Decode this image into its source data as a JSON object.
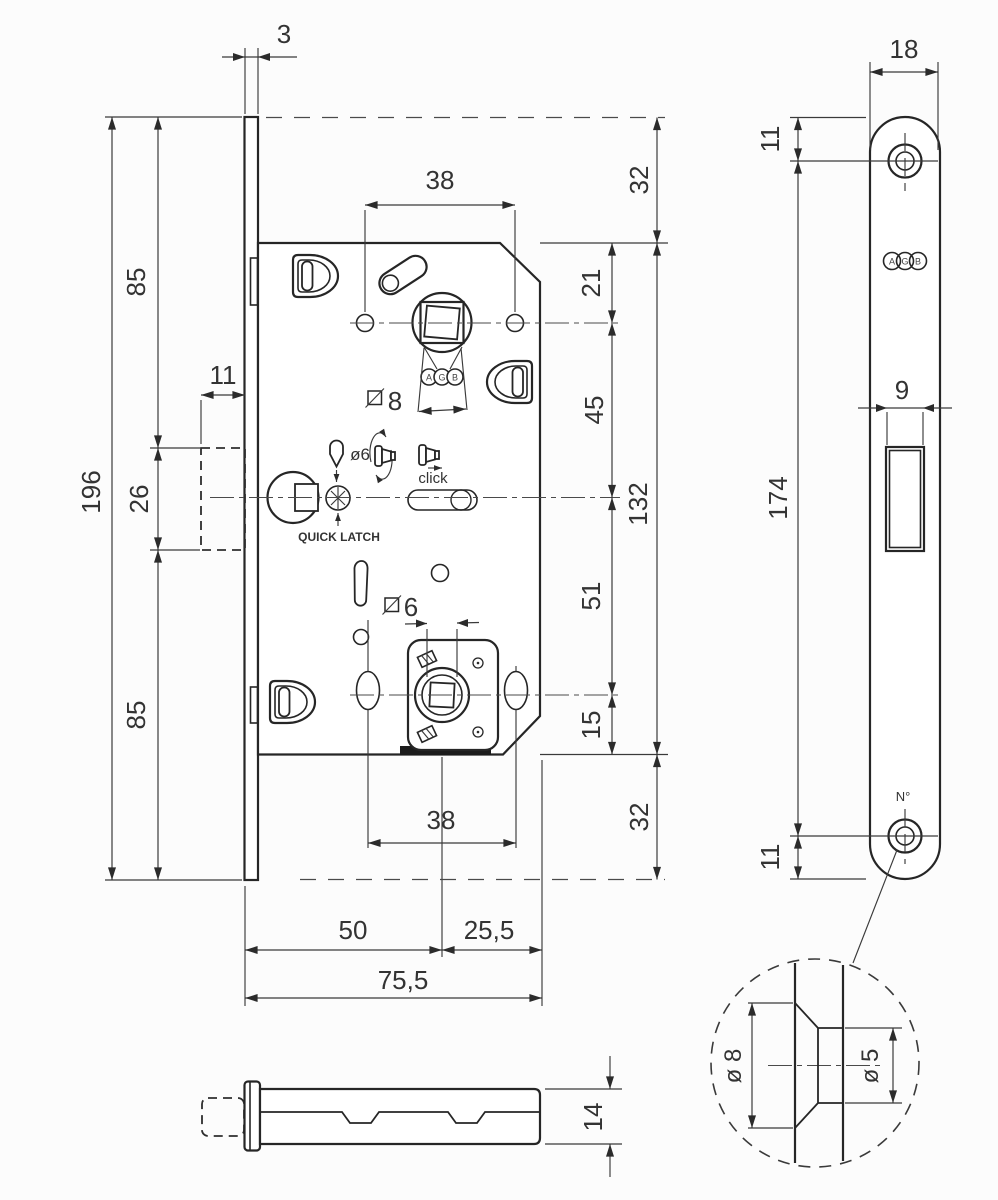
{
  "colors": {
    "line": "#262626",
    "background": "#fcfcfc"
  },
  "front": {
    "dim_faceplate_thickness": "3",
    "dim_faceplate_height": "196",
    "dim_top_to_latch": "85",
    "dim_latch_height": "26",
    "dim_latch_to_bottom": "85",
    "dim_latch_protrusion": "11",
    "dim_top_holes_span": "38",
    "dim_bottom_holes_span": "38",
    "dim_top_to_spindle": "21",
    "dim_spindle_to_center": "45",
    "dim_center_to_wc": "51",
    "dim_wc_to_case_bottom": "15",
    "dim_case_height": "132",
    "dim_overhang_top": "32",
    "dim_overhang_bottom": "32",
    "dim_backset": "50",
    "dim_backset_to_case_edge": "25,5",
    "dim_case_depth": "75,5",
    "dim_spindle_square": "8",
    "dim_wc_square": "6",
    "label_pin_hole": "ø6",
    "label_click": "click",
    "label_quick_latch": "QUICK LATCH",
    "brand": {
      "a": "A",
      "g": "G",
      "b": "B"
    }
  },
  "side": {
    "dim_width": "18",
    "dim_top_hole_offset": "11",
    "dim_holes_span": "174",
    "dim_bottom_hole_offset": "11",
    "dim_latch_slot_width": "9",
    "label_serial": "N°",
    "brand": {
      "a": "A",
      "g": "G",
      "b": "B"
    }
  },
  "bottom": {
    "dim_case_thickness": "14"
  },
  "detail": {
    "dim_outer_diameter": "ø 8",
    "dim_inner_diameter": "ø 5"
  }
}
